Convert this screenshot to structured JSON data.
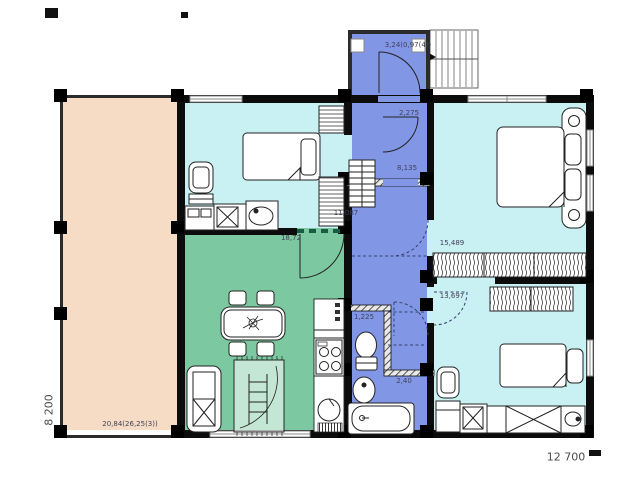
{
  "title": "House floor plan",
  "labels": {
    "porch_area": "3,24(0,97(4))",
    "hall_width": "2,275",
    "hall_area": "8,135",
    "kids_room_area": "11,087",
    "living_room_area": "18,72",
    "terrace_area": "20,84(26,25(3))",
    "wc_width": "1,225",
    "bath_width": "2,40",
    "bedroom_area": "15,489",
    "bedroom2_area": "13,697"
  },
  "dimensions": {
    "overall_width": "12 700",
    "overall_depth": "8 200"
  },
  "colors": {
    "terrace": "#f6dcc4",
    "bedrooms": "#c9f0f2",
    "living_room": "#7cc8a0",
    "hall": "#8296e6",
    "walls": "#0c0c0c"
  }
}
